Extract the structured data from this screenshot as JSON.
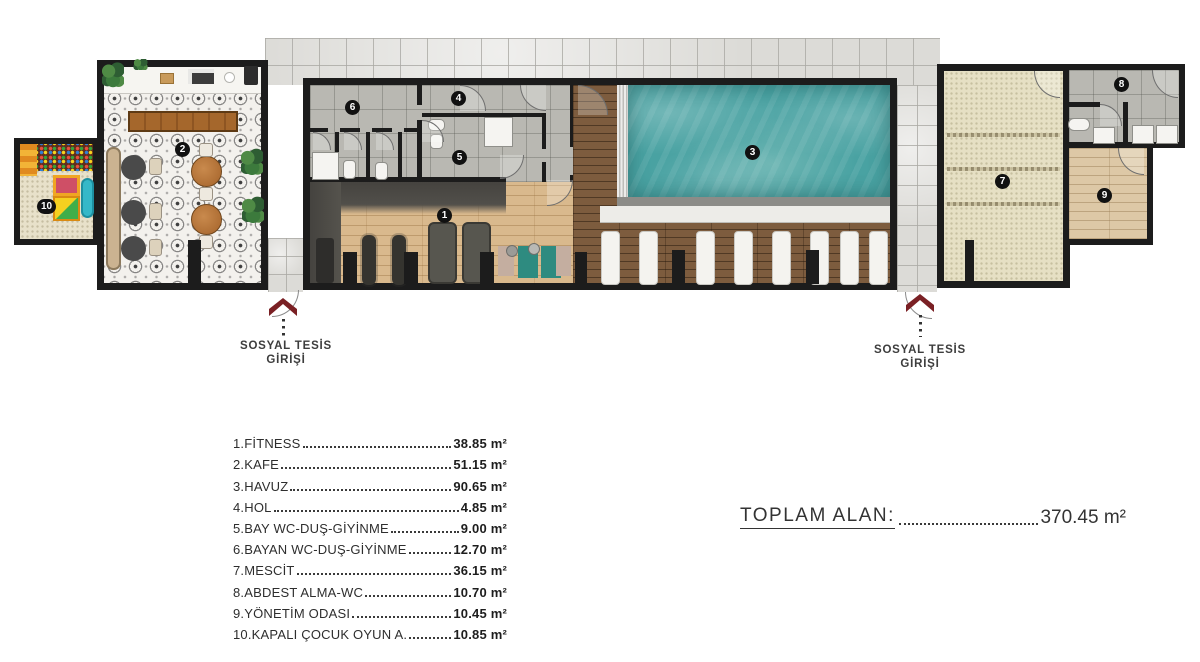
{
  "plan": {
    "badges": [
      "1",
      "2",
      "3",
      "4",
      "5",
      "6",
      "7",
      "8",
      "9",
      "10"
    ],
    "entrances": {
      "left": {
        "line1": "SOSYAL TESİS",
        "line2": "GİRİŞİ"
      },
      "right": {
        "line1": "SOSYAL TESİS",
        "line2": "GİRİŞİ"
      }
    }
  },
  "legend": {
    "items": [
      {
        "name": "1.FİTNESS",
        "area": "38.85 m²"
      },
      {
        "name": "2.KAFE",
        "area": "51.15 m²"
      },
      {
        "name": "3.HAVUZ",
        "area": "90.65 m²"
      },
      {
        "name": "4.HOL",
        "area": "4.85 m²"
      },
      {
        "name": "5.BAY WC-DUŞ-GİYİNME",
        "area": "9.00 m²"
      },
      {
        "name": "6.BAYAN WC-DUŞ-GİYİNME",
        "area": "12.70 m²"
      },
      {
        "name": "7.MESCİT",
        "area": "36.15 m²"
      },
      {
        "name": "8.ABDEST ALMA-WC",
        "area": "10.70 m²"
      },
      {
        "name": "9.YÖNETİM ODASI",
        "area": "10.45 m²"
      },
      {
        "name": "10.KAPALI ÇOCUK OYUN A.",
        "area": "10.85 m²"
      }
    ]
  },
  "total": {
    "label": "TOPLAM ALAN:",
    "value": "370.45 m²"
  },
  "colors": {
    "wall": "#1c1c1c",
    "pool_water": "#49a2a2",
    "pool_deck": "#7d5c3e",
    "fitness_wood": "#d9b98d",
    "marble": "#dcdbd7",
    "carpet": "#e6e0c4",
    "entrance_arrow": "#7a2024"
  }
}
